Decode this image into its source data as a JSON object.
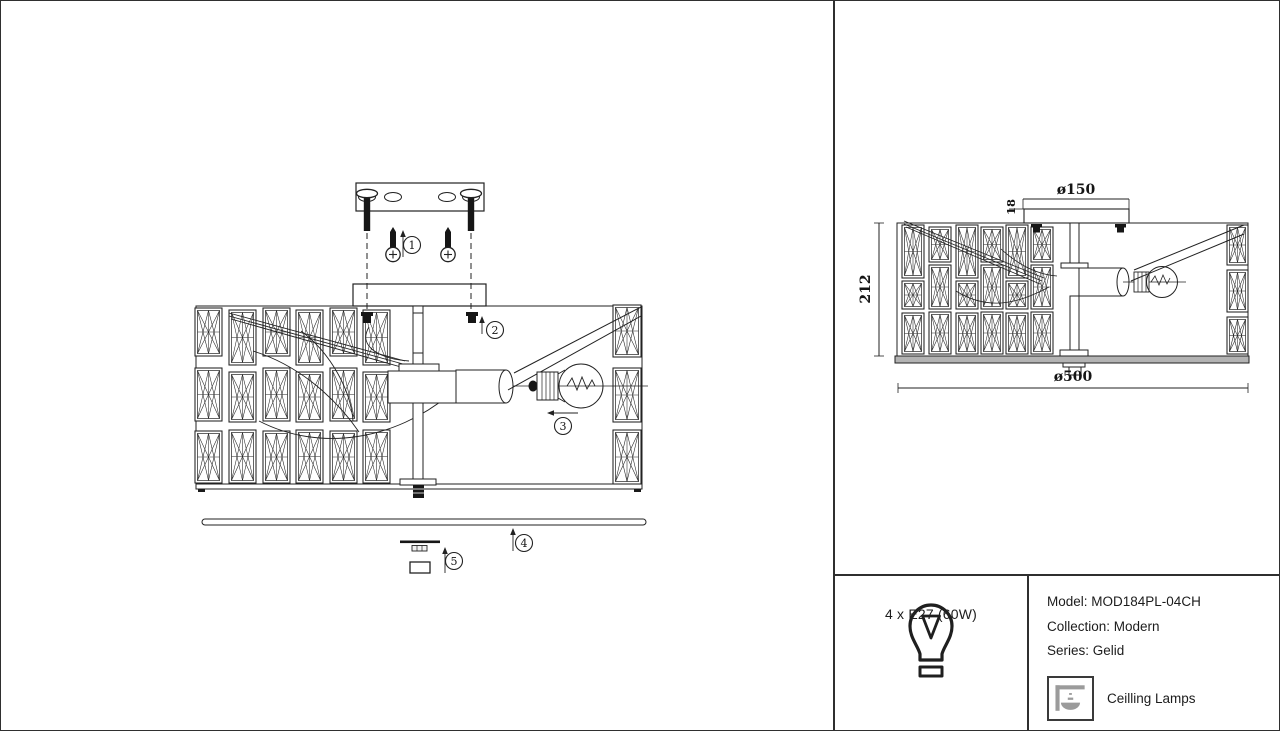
{
  "page": {
    "background": "#ffffff",
    "line_color": "#222222",
    "plate_gray": "#b3b3b3",
    "icon_gray": "#9b9b9b"
  },
  "left_drawing": {
    "description": "exploded assembly view of ceiling lamp",
    "callouts": [
      "1",
      "2",
      "3",
      "4",
      "5"
    ]
  },
  "right_drawing": {
    "description": "dimensioned side view of ceiling lamp",
    "dim_top_diameter": "ø150",
    "dim_canopy_height": "18",
    "dim_total_height": "212",
    "dim_total_diameter": "ø500"
  },
  "info_panel": {
    "bulb_spec": "4 x E27 (60W)",
    "model_line": "Model: MOD184PL-04CH",
    "collection_line": "Collection: Modern",
    "series_line": "Series: Gelid",
    "category_label": "Ceilling Lamps"
  }
}
